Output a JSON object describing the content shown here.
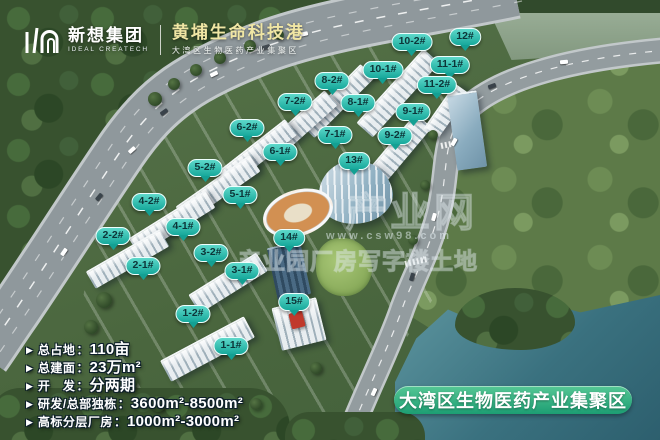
{
  "header": {
    "logo_name": "新想集团",
    "logo_name_en": "IDEAL CREATECH",
    "title": "黄埔生命科技港",
    "subtitle": "大湾区生物医药产业集聚区"
  },
  "building_labels": [
    {
      "id": "1-1#",
      "x": 231,
      "y": 337
    },
    {
      "id": "1-2#",
      "x": 193,
      "y": 305
    },
    {
      "id": "2-1#",
      "x": 143,
      "y": 257
    },
    {
      "id": "2-2#",
      "x": 113,
      "y": 227
    },
    {
      "id": "3-1#",
      "x": 242,
      "y": 262
    },
    {
      "id": "3-2#",
      "x": 211,
      "y": 244
    },
    {
      "id": "4-1#",
      "x": 183,
      "y": 218
    },
    {
      "id": "4-2#",
      "x": 149,
      "y": 193
    },
    {
      "id": "5-1#",
      "x": 240,
      "y": 186
    },
    {
      "id": "5-2#",
      "x": 205,
      "y": 159
    },
    {
      "id": "6-1#",
      "x": 280,
      "y": 143
    },
    {
      "id": "6-2#",
      "x": 247,
      "y": 119
    },
    {
      "id": "7-1#",
      "x": 335,
      "y": 126
    },
    {
      "id": "7-2#",
      "x": 295,
      "y": 93
    },
    {
      "id": "8-1#",
      "x": 358,
      "y": 94
    },
    {
      "id": "8-2#",
      "x": 332,
      "y": 72
    },
    {
      "id": "9-1#",
      "x": 413,
      "y": 103
    },
    {
      "id": "9-2#",
      "x": 395,
      "y": 127
    },
    {
      "id": "10-1#",
      "x": 383,
      "y": 61
    },
    {
      "id": "10-2#",
      "x": 412,
      "y": 33
    },
    {
      "id": "11-1#",
      "x": 450,
      "y": 56
    },
    {
      "id": "11-2#",
      "x": 437,
      "y": 76
    },
    {
      "id": "12#",
      "x": 465,
      "y": 28
    },
    {
      "id": "13#",
      "x": 354,
      "y": 152
    },
    {
      "id": "14#",
      "x": 289,
      "y": 229
    },
    {
      "id": "15#",
      "x": 294,
      "y": 293
    }
  ],
  "stats": {
    "bullet": "▶",
    "colon": "：",
    "items": [
      {
        "label": "总占地",
        "value": "110亩"
      },
      {
        "label": "总建面",
        "value": "23万m²"
      },
      {
        "label": "开　发",
        "value": "分两期"
      },
      {
        "label": "研发/总部独栋",
        "value": "3600m²-8500m²"
      },
      {
        "label": "高标分层厂房",
        "value": "1000m²-3000m²"
      }
    ]
  },
  "banner": {
    "text": "大湾区生物医药产业集聚区"
  },
  "watermark": {
    "brand": "产业网",
    "categories": "产业园厂房写字楼土地",
    "url": "www.csw98.com"
  },
  "colors": {
    "label_teal": "#17a89b",
    "banner_green": "#1d9e73",
    "title_yellow": "#f0e6a4"
  }
}
